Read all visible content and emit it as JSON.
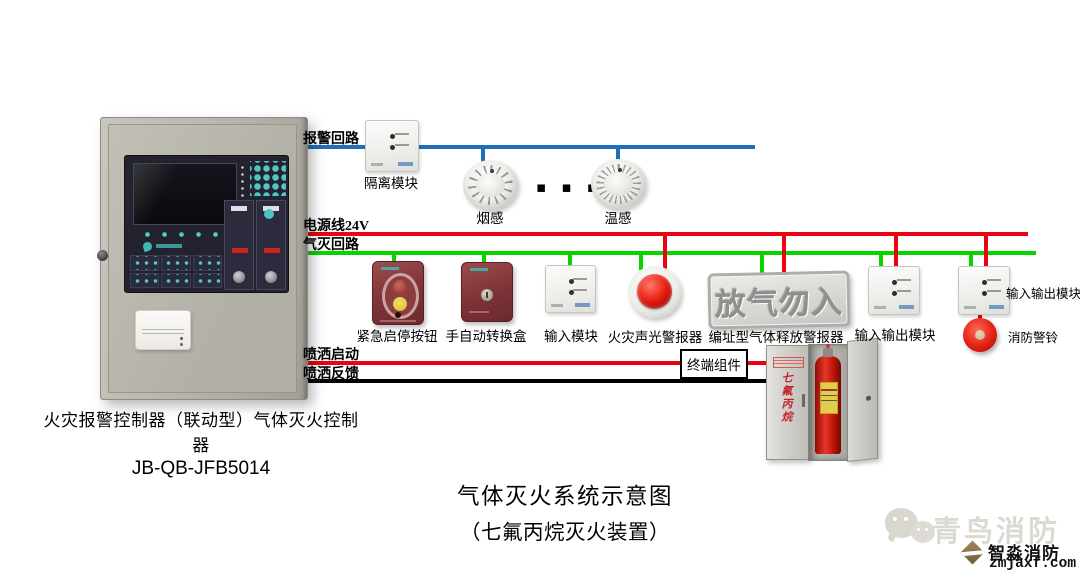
{
  "title": {
    "line1": "气体灭火系统示意图",
    "line2": "（七氟丙烷灭火装置）"
  },
  "panel": {
    "caption_line1": "火灾报警控制器（联动型）气体灭火控制器",
    "caption_line2": "JB-QB-JFB5014"
  },
  "loops": {
    "alarm": "报警回路",
    "power": "电源线24V",
    "gas": "气灭回路",
    "spray_start": "喷洒启动",
    "spray_feedback": "喷洒反馈"
  },
  "devices": {
    "isolation": "隔离模块",
    "smoke": "烟感",
    "heat": "温感",
    "ellipsis": "▪ ▪ ▪",
    "emergency": "紧急启停按钮",
    "manual_auto": "手自动转换盒",
    "input": "输入模块",
    "sound_light": "火灾声光警报器",
    "release_sign": "放气勿入",
    "release_alarm": "编址型气体释放警报器",
    "io1": "输入输出模块",
    "io2": "输入输出模块",
    "bell": "消防警铃",
    "terminal": "终端组件",
    "cabinet_text": "七氟丙烷"
  },
  "watermark": {
    "wechat_brand": "青鸟消防",
    "brand": "智淼消防",
    "site": "zmjaxf.com"
  },
  "colors": {
    "alarm_loop": "#1d6fbd",
    "power_line": "#e90410",
    "gas_loop": "#0ad400",
    "spray_feedback": "#000000"
  }
}
